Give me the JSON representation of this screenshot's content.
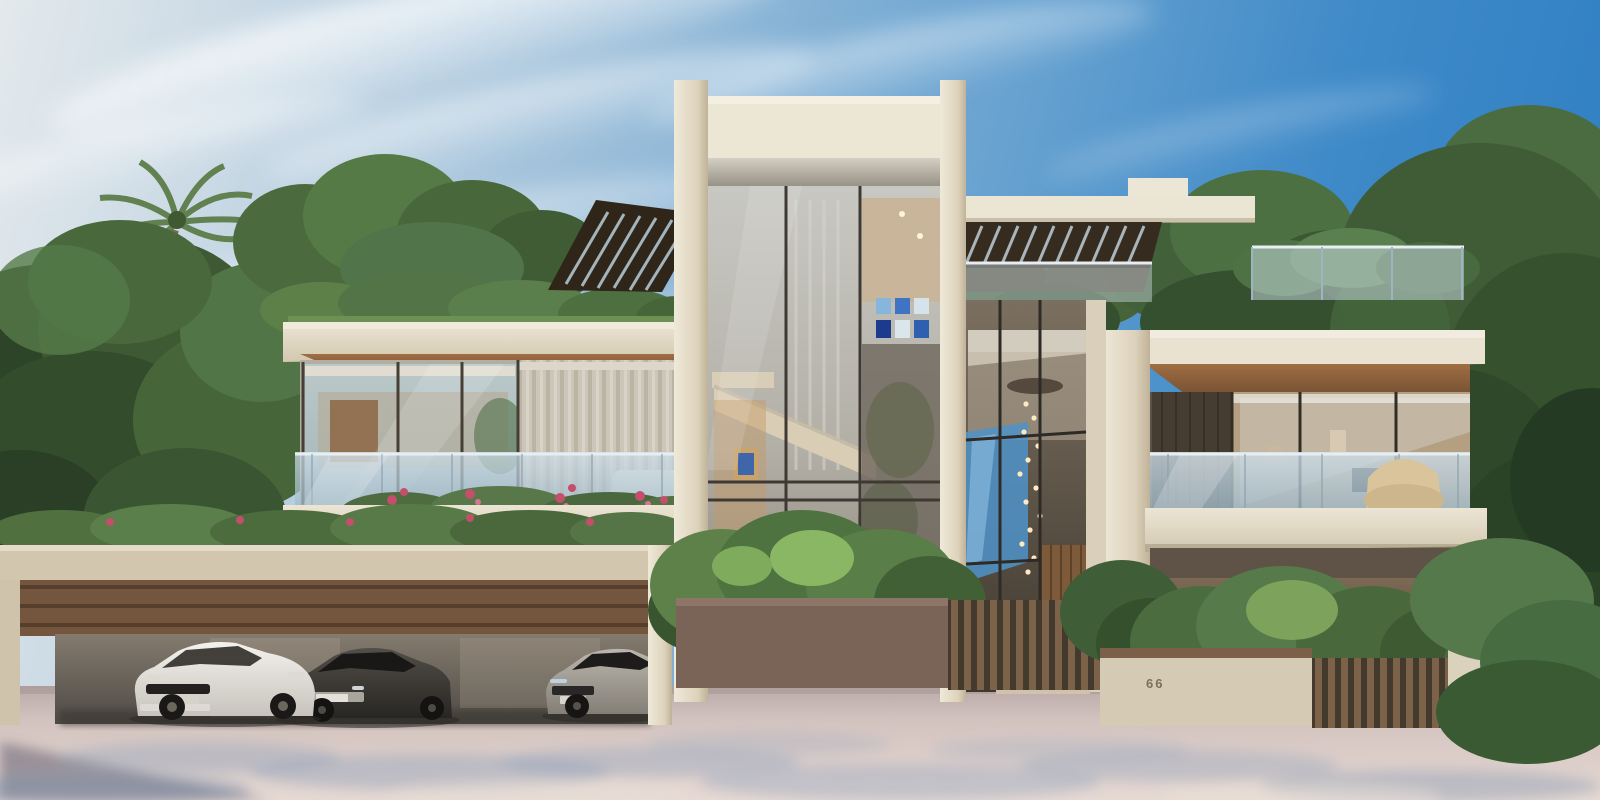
{
  "scene": {
    "type": "3d-architectural-exterior-render",
    "subject": "Modern two-storey luxury villa with central double-height glass atrium, rooftop louvered pergolas, planted green roof, glass-railed balconies and a three-car garage",
    "time_of_day": "daytime, clear sky with thin streaky clouds",
    "house_number": "66",
    "vegetation": [
      "palm tree left",
      "dense mature trees both sides",
      "green roof hedge",
      "balcony planter with pink roses",
      "front shrubs along planter walls",
      "conifer at lower right"
    ],
    "vehicles": [
      {
        "name": "white-sedan",
        "body_color": "#ece9e4"
      },
      {
        "name": "dark-gray-sedan",
        "body_color": "#3b3835"
      },
      {
        "name": "silver-sedan",
        "body_color": "#a19b91"
      }
    ],
    "architecture": {
      "left_wing": "upper-floor glass lounge with sheer curtains, glass balustrade balcony and planted roof with slatted pergola",
      "garage": "wide carport with slatted wood header band, concrete beam and three parked sedans",
      "central_tower": "full-height glass curtain wall between beige piers with interior staircase and blue wall art",
      "entrance": "double-height glazed foyer with cascading pendant chandelier and vertical wood door",
      "right_wing": "cantilevered balcony with wicker chair above a glazed ground floor with black pendant lamp",
      "site": "low rendered walls with wood-slat fences, brown planter wall, pink-toned paved driveway with dappled tree shadows"
    },
    "palette": {
      "sky_deep_blue": "#2b7cc2",
      "sky_haze": "#e3e9ec",
      "cloud_white": "#f4f7f9",
      "concrete_beige": "#ddd3bf",
      "concrete_light": "#ece6d5",
      "wood_brown": "#8a6040",
      "louver_dark": "#352b1f",
      "glass_reflection_blue": "#a8c4d4",
      "glass_dark": "#463f38",
      "foliage_dark": "#2e4429",
      "foliage_light": "#7fa05e",
      "flower_pink": "#c2506b",
      "driveway_mauve": "#d8c7c4",
      "shadow_blue_gray": "#8fa3bb",
      "artwork_blue": "#2f5fb0"
    }
  }
}
